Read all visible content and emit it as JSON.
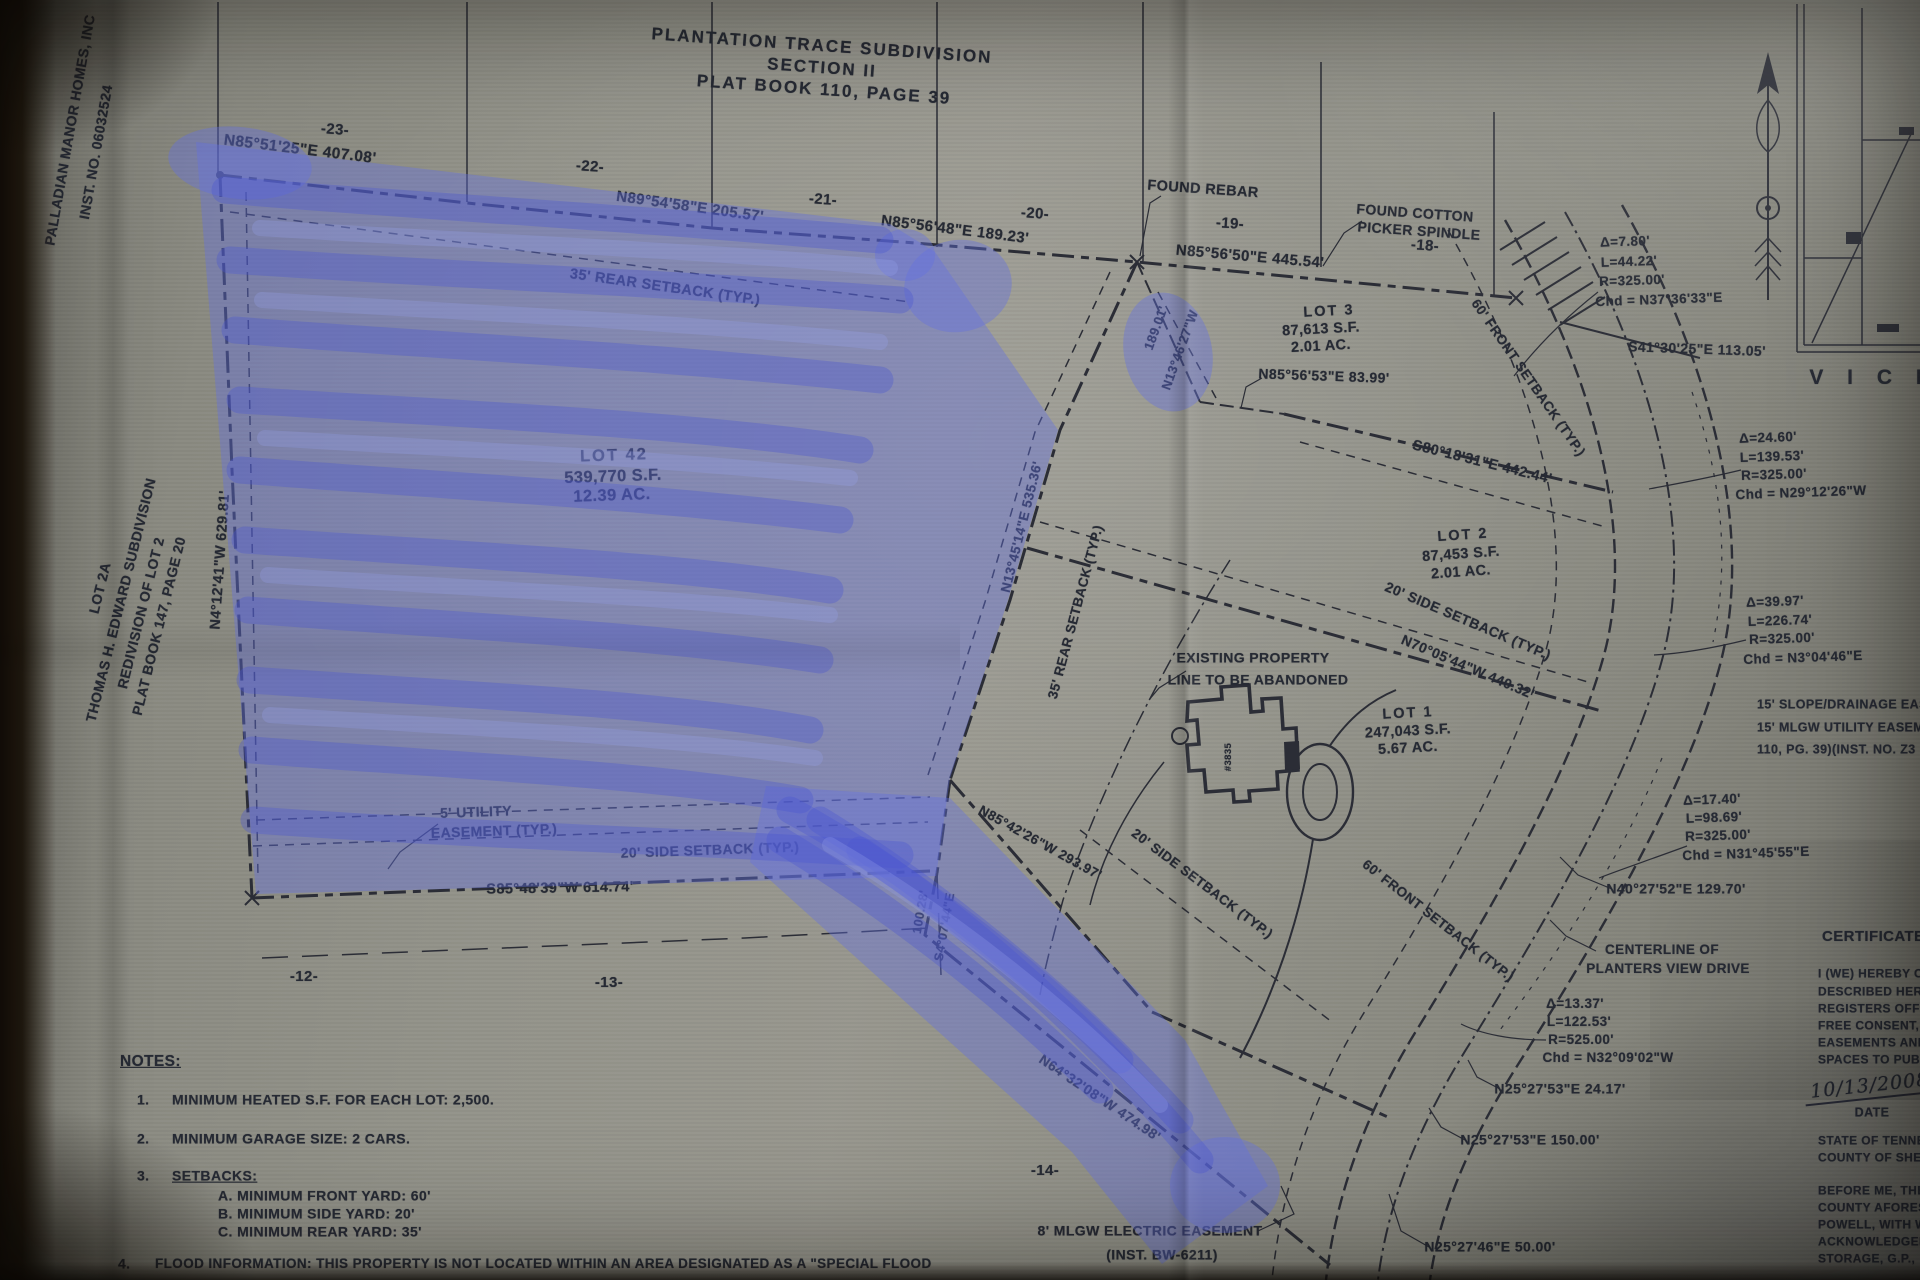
{
  "colors": {
    "ink": "#2b2d36",
    "ink2": "#262a34",
    "paper": "#93938a",
    "background": "#15100a",
    "highlighter_fill": "#6470e0",
    "highlighter_stroke": "#4a55d2",
    "highlighter_light": "#98a2ee"
  },
  "summary": {
    "title": {
      "line1": "PLANTATION TRACE SUBDIVISION",
      "line2": "SECTION II",
      "line3": "PLAT BOOK 110, PAGE 39"
    },
    "owner_note": [
      "PALLADIAN MANOR HOMES, INC",
      "INST. NO. 06032524"
    ],
    "adjacent_property": [
      "LOT 2A",
      "THOMAS H. EDWARD SUBDIVISION",
      "REDIVISION OF LOT 2",
      "PLAT BOOK 147, PAGE 20"
    ],
    "lots": [
      {
        "name": "LOT 42",
        "area_sf": "539,770 S.F.",
        "acres": "12.39 AC."
      },
      {
        "name": "LOT 3",
        "area_sf": "87,613 S.F.",
        "acres": "2.01 AC."
      },
      {
        "name": "LOT 2",
        "area_sf": "87,453 S.F.",
        "acres": "2.01 AC."
      },
      {
        "name": "LOT 1",
        "area_sf": "247,043 S.F.",
        "acres": "5.67 AC."
      }
    ],
    "curves": [
      {
        "delta": "Δ=7.80'",
        "length": "L=44.22'",
        "radius": "R=325.00'",
        "chord": "Chd = N37°36'33\"E"
      },
      {
        "delta": "Δ=24.60'",
        "length": "L=139.53'",
        "radius": "R=325.00'",
        "chord": "Chd = N29°12'26\"W"
      },
      {
        "delta": "Δ=39.97'",
        "length": "L=226.74'",
        "radius": "R=325.00'",
        "chord": "Chd = N3°04'46\"E"
      },
      {
        "delta": "Δ=17.40'",
        "length": "L=98.69'",
        "radius": "R=325.00'",
        "chord": "Chd = N31°45'55\"E"
      },
      {
        "delta": "Δ=13.37'",
        "length": "L=122.53'",
        "radius": "R=525.00'",
        "chord": "Chd = N32°09'02\"W"
      }
    ],
    "street": "PLANTERS VIEW DRIVE",
    "notes_heading": "NOTES:",
    "notes": [
      "MINIMUM HEATED S.F. FOR EACH LOT: 2,500.",
      "MINIMUM GARAGE SIZE: 2 CARS.",
      "SETBACKS:  A. MINIMUM FRONT YARD: 60'  B. MINIMUM SIDE YARD: 20'  C. MINIMUM REAR YARD: 35'",
      "FLOOD INFORMATION: THIS PROPERTY IS NOT LOCATED WITHIN AN AREA DESIGNATED AS A \"SPECIAL FLOOD"
    ],
    "certificate_partial": [
      "CERTIFICATE O",
      "I (WE) HEREBY C",
      "DESCRIBED HERE",
      "REGISTERS OFFIC",
      "FREE CONSENT, E",
      "EASEMENTS AND",
      "SPACES TO PUBL",
      "DATE",
      "STATE OF TENNE",
      "COUNTY OF SHEL",
      "BEFORE ME, THE",
      "COUNTY AFORESA",
      "POWELL, WITH W",
      "ACKNOWLEDGED",
      "STORAGE, G.P.,"
    ],
    "date_handwritten": "10/13/2008"
  },
  "labels": [
    {
      "n": "title-line-1",
      "t": "PLANTATION TRACE SUBDIVISION",
      "x": 822,
      "y": 46,
      "r": 4,
      "s": 17,
      "ls": 2
    },
    {
      "n": "title-line-2",
      "t": "SECTION II",
      "x": 822,
      "y": 68,
      "r": 4,
      "s": 17,
      "ls": 2
    },
    {
      "n": "title-line-3",
      "t": "PLAT BOOK 110, PAGE 39",
      "x": 824,
      "y": 90,
      "r": 4,
      "s": 17,
      "ls": 2
    },
    {
      "n": "owner-name",
      "t": "PALLADIAN MANOR HOMES, INC",
      "x": 70,
      "y": 130,
      "r": -80,
      "s": 14
    },
    {
      "n": "owner-inst-no",
      "t": "INST. NO. 06032524",
      "x": 96,
      "y": 152,
      "r": -80,
      "s": 14
    },
    {
      "n": "adjacent-lot2a",
      "t": "LOT 2A",
      "x": 100,
      "y": 588,
      "r": -76,
      "s": 14
    },
    {
      "n": "adjacent-subdivision",
      "t": "THOMAS H. EDWARD SUBDIVISION",
      "x": 121,
      "y": 600,
      "r": -76,
      "s": 14
    },
    {
      "n": "adjacent-redivision",
      "t": "REDIVISION OF LOT 2",
      "x": 141,
      "y": 613,
      "r": -76,
      "s": 14
    },
    {
      "n": "adjacent-platbook",
      "t": "PLAT BOOK 147, PAGE 20",
      "x": 159,
      "y": 626,
      "r": -76,
      "s": 14
    },
    {
      "n": "bearing-west",
      "t": "N4°12'41\"W 629.81'",
      "x": 221,
      "y": 560,
      "r": -86,
      "s": 14.5
    },
    {
      "n": "grid-23",
      "t": "-23-",
      "x": 335,
      "y": 130,
      "r": 4,
      "s": 15
    },
    {
      "n": "grid-22",
      "t": "-22-",
      "x": 590,
      "y": 167,
      "r": 4,
      "s": 15
    },
    {
      "n": "grid-21",
      "t": "-21-",
      "x": 823,
      "y": 200,
      "r": 4,
      "s": 15
    },
    {
      "n": "grid-20",
      "t": "-20-",
      "x": 1035,
      "y": 214,
      "r": 4,
      "s": 15
    },
    {
      "n": "grid-19",
      "t": "-19-",
      "x": 1230,
      "y": 224,
      "r": 4,
      "s": 15
    },
    {
      "n": "grid-18",
      "t": "-18-",
      "x": 1425,
      "y": 246,
      "r": 4,
      "s": 15
    },
    {
      "n": "grid-12",
      "t": "-12-",
      "x": 304,
      "y": 977,
      "r": 0,
      "s": 15
    },
    {
      "n": "grid-13",
      "t": "-13-",
      "x": 609,
      "y": 983,
      "r": 0,
      "s": 15
    },
    {
      "n": "grid-14",
      "t": "-14-",
      "x": 1045,
      "y": 1171,
      "r": 0,
      "s": 15
    },
    {
      "n": "bearing-north-1",
      "t": "N85°51'25\"E 407.08'",
      "x": 300,
      "y": 150,
      "r": 7,
      "s": 15.5
    },
    {
      "n": "bearing-north-2",
      "t": "N89°54'58\"E 205.57'",
      "x": 690,
      "y": 207,
      "r": 8,
      "s": 15
    },
    {
      "n": "bearing-north-3",
      "t": "N85°56'48\"E 189.23'",
      "x": 955,
      "y": 230,
      "r": 7,
      "s": 15
    },
    {
      "n": "bearing-north-4",
      "t": "N85°56'50\"E 445.54'",
      "x": 1250,
      "y": 257,
      "r": 5,
      "s": 15
    },
    {
      "n": "found-rebar-label",
      "t": "FOUND REBAR",
      "x": 1203,
      "y": 190,
      "r": 4,
      "s": 14.5
    },
    {
      "n": "found-cotton-label-1",
      "t": "FOUND COTTON",
      "x": 1415,
      "y": 213,
      "r": 4,
      "s": 14
    },
    {
      "n": "found-cotton-label-2",
      "t": "PICKER SPINDLE",
      "x": 1419,
      "y": 231,
      "r": 4,
      "s": 14
    },
    {
      "n": "rear-setback-top",
      "t": "35' REAR SETBACK (TYP.)",
      "x": 665,
      "y": 288,
      "r": 8,
      "s": 14.5
    },
    {
      "n": "lot42-name",
      "t": "LOT 42",
      "x": 614,
      "y": 456,
      "r": -2,
      "s": 16.5,
      "ls": 2
    },
    {
      "n": "lot42-area",
      "t": "539,770 S.F.",
      "x": 613,
      "y": 477,
      "r": -2,
      "s": 16.5
    },
    {
      "n": "lot42-acres",
      "t": "12.39 AC.",
      "x": 612,
      "y": 496,
      "r": -2,
      "s": 16.5
    },
    {
      "n": "dist-189",
      "t": "189.01'",
      "x": 1156,
      "y": 328,
      "r": -70,
      "s": 13
    },
    {
      "n": "bearing-n1346",
      "t": "N13°46'27\"W",
      "x": 1180,
      "y": 350,
      "r": -70,
      "s": 13
    },
    {
      "n": "lot3-name",
      "t": "LOT 3",
      "x": 1329,
      "y": 312,
      "r": -3,
      "s": 14.5,
      "ls": 2
    },
    {
      "n": "lot3-area",
      "t": "87,613 S.F.",
      "x": 1321,
      "y": 330,
      "r": -3,
      "s": 14.5
    },
    {
      "n": "lot3-acres",
      "t": "2.01 AC.",
      "x": 1321,
      "y": 347,
      "r": -3,
      "s": 14.5
    },
    {
      "n": "bearing-lot3-south",
      "t": "N85°56'53\"E 83.99'",
      "x": 1324,
      "y": 376,
      "r": 2,
      "s": 14
    },
    {
      "n": "front-setback-upper",
      "t": "60' FRONT SETBACK (TYP.)",
      "x": 1528,
      "y": 378,
      "r": 55,
      "s": 13.5
    },
    {
      "n": "bearing-s41",
      "t": "S41°30'25\"E 113.05'",
      "x": 1697,
      "y": 349,
      "r": 2,
      "s": 14
    },
    {
      "n": "curve1-delta",
      "t": "Δ=7.80'",
      "x": 1625,
      "y": 242,
      "r": -2,
      "s": 13.5
    },
    {
      "n": "curve1-length",
      "t": "L=44.22'",
      "x": 1629,
      "y": 262,
      "r": -2,
      "s": 13.5
    },
    {
      "n": "curve1-radius",
      "t": "R=325.00'",
      "x": 1632,
      "y": 281,
      "r": -2,
      "s": 13.5
    },
    {
      "n": "curve1-chord",
      "t": "Chd = N37°36'33\"E",
      "x": 1659,
      "y": 300,
      "r": -2,
      "s": 13.5
    },
    {
      "n": "curve2-delta",
      "t": "Δ=24.60'",
      "x": 1768,
      "y": 438,
      "r": -2,
      "s": 13.5
    },
    {
      "n": "curve2-length",
      "t": "L=139.53'",
      "x": 1772,
      "y": 457,
      "r": -2,
      "s": 13.5
    },
    {
      "n": "curve2-radius",
      "t": "R=325.00'",
      "x": 1774,
      "y": 475,
      "r": -2,
      "s": 13.5
    },
    {
      "n": "curve2-chord",
      "t": "Chd = N29°12'26\"W",
      "x": 1801,
      "y": 493,
      "r": -2,
      "s": 13.5
    },
    {
      "n": "vicinity-caption",
      "t": "V I C I",
      "x": 1870,
      "y": 378,
      "r": 0,
      "s": 21,
      "ls": 9
    },
    {
      "n": "bearing-s80",
      "t": "S80°18'31\"E 442.44'",
      "x": 1482,
      "y": 463,
      "r": 14,
      "s": 14.5
    },
    {
      "n": "lot2-name",
      "t": "LOT 2",
      "x": 1463,
      "y": 536,
      "r": -4,
      "s": 14.5,
      "ls": 2
    },
    {
      "n": "lot2-area",
      "t": "87,453 S.F.",
      "x": 1461,
      "y": 555,
      "r": -4,
      "s": 14.5
    },
    {
      "n": "lot2-acres",
      "t": "2.01 AC.",
      "x": 1461,
      "y": 573,
      "r": -4,
      "s": 14.5
    },
    {
      "n": "side-setback-lot2",
      "t": "20' SIDE SETBACK (TYP.)",
      "x": 1468,
      "y": 621,
      "r": 23,
      "s": 14
    },
    {
      "n": "bearing-n70",
      "t": "N70°05'44\"W 440.32'",
      "x": 1468,
      "y": 667,
      "r": 23,
      "s": 14
    },
    {
      "n": "curve3-delta",
      "t": "Δ=39.97'",
      "x": 1775,
      "y": 602,
      "r": -2,
      "s": 13.5
    },
    {
      "n": "curve3-length",
      "t": "L=226.74'",
      "x": 1780,
      "y": 621,
      "r": -2,
      "s": 13.5
    },
    {
      "n": "curve3-radius",
      "t": "R=325.00'",
      "x": 1782,
      "y": 639,
      "r": -2,
      "s": 13.5
    },
    {
      "n": "curve3-chord",
      "t": "Chd = N3°04'46\"E",
      "x": 1803,
      "y": 658,
      "r": -2,
      "s": 13.5
    },
    {
      "n": "slope-easement-1",
      "t": "15' SLOPE/DRAINAGE EASE",
      "x": 1757,
      "y": 705,
      "r": 0,
      "s": 12.5,
      "al": "l"
    },
    {
      "n": "slope-easement-2",
      "t": "15' MLGW UTILITY EASEMEN",
      "x": 1757,
      "y": 728,
      "r": 0,
      "s": 12.5,
      "al": "l"
    },
    {
      "n": "slope-easement-3",
      "t": "110, PG. 39)(INST. NO. Z3",
      "x": 1757,
      "y": 750,
      "r": 0,
      "s": 12.5,
      "al": "l"
    },
    {
      "n": "rear-setback-diagonal",
      "t": "35' REAR SETBACK (TYP.)",
      "x": 1076,
      "y": 612,
      "r": -75,
      "s": 13.5
    },
    {
      "n": "bearing-n1345",
      "t": "N13°45'14\"E 535.36'",
      "x": 1022,
      "y": 527,
      "r": -76,
      "s": 13.5
    },
    {
      "n": "existing-line-label-1",
      "t": "EXISTING PROPERTY",
      "x": 1253,
      "y": 658,
      "r": 0,
      "s": 14
    },
    {
      "n": "existing-line-label-2",
      "t": "LINE TO BE ABANDONED",
      "x": 1258,
      "y": 680,
      "r": 0,
      "s": 14
    },
    {
      "n": "lot1-name",
      "t": "LOT 1",
      "x": 1408,
      "y": 714,
      "r": -3,
      "s": 14.5,
      "ls": 2
    },
    {
      "n": "lot1-area",
      "t": "247,043 S.F.",
      "x": 1408,
      "y": 732,
      "r": -3,
      "s": 14.5
    },
    {
      "n": "lot1-acres",
      "t": "5.67 AC.",
      "x": 1408,
      "y": 749,
      "r": -3,
      "s": 14.5
    },
    {
      "n": "house-number",
      "t": "#3835",
      "x": 1229,
      "y": 757,
      "r": -90,
      "s": 9.5
    },
    {
      "n": "curve4-delta",
      "t": "Δ=17.40'",
      "x": 1712,
      "y": 800,
      "r": -2,
      "s": 13.5
    },
    {
      "n": "curve4-length",
      "t": "L=98.69'",
      "x": 1714,
      "y": 818,
      "r": -2,
      "s": 13.5
    },
    {
      "n": "curve4-radius",
      "t": "R=325.00'",
      "x": 1718,
      "y": 836,
      "r": -2,
      "s": 13.5
    },
    {
      "n": "curve4-chord",
      "t": "Chd = N31°45'55\"E",
      "x": 1746,
      "y": 854,
      "r": -2,
      "s": 13.5
    },
    {
      "n": "bearing-n40",
      "t": "N40°27'52\"E 129.70'",
      "x": 1676,
      "y": 889,
      "r": 0,
      "s": 14
    },
    {
      "n": "centerline-label-1",
      "t": "CENTERLINE OF",
      "x": 1662,
      "y": 950,
      "r": 0,
      "s": 13.5
    },
    {
      "n": "centerline-label-2",
      "t": "PLANTERS VIEW DRIVE",
      "x": 1668,
      "y": 969,
      "r": 0,
      "s": 13.5
    },
    {
      "n": "front-setback-lower",
      "t": "60' FRONT SETBACK (TYP.)",
      "x": 1438,
      "y": 921,
      "r": 38,
      "s": 13.5
    },
    {
      "n": "side-setback-lot1",
      "t": "20' SIDE SETBACK (TYP.)",
      "x": 1202,
      "y": 884,
      "r": 37,
      "s": 13.5
    },
    {
      "n": "bearing-n8542",
      "t": "N85°42'26\"W 293.97'",
      "x": 1040,
      "y": 843,
      "r": 29,
      "s": 13.5
    },
    {
      "n": "dist-10028",
      "t": "100.28'",
      "x": 921,
      "y": 912,
      "r": -80,
      "s": 12.5
    },
    {
      "n": "bearing-s407",
      "t": "S4°07'44\"E",
      "x": 945,
      "y": 927,
      "r": -80,
      "s": 12.5
    },
    {
      "n": "utility-easement-1",
      "t": "5' UTILITY",
      "x": 476,
      "y": 812,
      "r": -2,
      "s": 14
    },
    {
      "n": "utility-easement-2",
      "t": "EASEMENT (TYP.)",
      "x": 494,
      "y": 831,
      "r": -2,
      "s": 14
    },
    {
      "n": "side-setback-lot42",
      "t": "20' SIDE SETBACK (TYP.)",
      "x": 710,
      "y": 850,
      "r": -2,
      "s": 14
    },
    {
      "n": "bearing-s8548",
      "t": "S85°48'39\"W 614.74'",
      "x": 560,
      "y": 889,
      "r": -1,
      "s": 14.5
    },
    {
      "n": "curve5-delta",
      "t": "Δ=13.37'",
      "x": 1575,
      "y": 1004,
      "r": 0,
      "s": 13.5
    },
    {
      "n": "curve5-length",
      "t": "L=122.53'",
      "x": 1579,
      "y": 1022,
      "r": 0,
      "s": 13.5
    },
    {
      "n": "curve5-radius",
      "t": "R=525.00'",
      "x": 1581,
      "y": 1040,
      "r": 0,
      "s": 13.5
    },
    {
      "n": "curve5-chord",
      "t": "Chd = N32°09'02\"W",
      "x": 1608,
      "y": 1058,
      "r": 0,
      "s": 13.5
    },
    {
      "n": "bearing-n25-2417",
      "t": "N25°27'53\"E 24.17'",
      "x": 1560,
      "y": 1089,
      "r": 0,
      "s": 14
    },
    {
      "n": "bearing-n25-150",
      "t": "N25°27'53\"E 150.00'",
      "x": 1530,
      "y": 1140,
      "r": 0,
      "s": 14
    },
    {
      "n": "bearing-n25-50",
      "t": "N25°27'46\"E 50.00'",
      "x": 1490,
      "y": 1247,
      "r": 0,
      "s": 14
    },
    {
      "n": "bearing-n64",
      "t": "N64°32'08\"W 474.98'",
      "x": 1100,
      "y": 1098,
      "r": 34,
      "s": 14
    },
    {
      "n": "mlgw-easement-1",
      "t": "8' MLGW ELECTRIC EASEMENT",
      "x": 1150,
      "y": 1231,
      "r": 0,
      "s": 14
    },
    {
      "n": "mlgw-easement-2",
      "t": "(INST. BW-6211)",
      "x": 1162,
      "y": 1255,
      "r": 0,
      "s": 14
    },
    {
      "n": "notes-heading",
      "t": "NOTES:",
      "x": 120,
      "y": 1062,
      "r": 0,
      "s": 15.5,
      "al": "l",
      "u": true
    },
    {
      "n": "note-1-num",
      "t": "1.",
      "x": 137,
      "y": 1100,
      "r": 0,
      "s": 14,
      "al": "l"
    },
    {
      "n": "note-1-text",
      "t": "MINIMUM HEATED S.F. FOR EACH LOT: 2,500.",
      "x": 172,
      "y": 1100,
      "r": 0,
      "s": 14,
      "al": "l"
    },
    {
      "n": "note-2-num",
      "t": "2.",
      "x": 137,
      "y": 1139,
      "r": 0,
      "s": 14,
      "al": "l"
    },
    {
      "n": "note-2-text",
      "t": "MINIMUM GARAGE SIZE: 2 CARS.",
      "x": 172,
      "y": 1139,
      "r": 0,
      "s": 14,
      "al": "l"
    },
    {
      "n": "note-3-num",
      "t": "3.",
      "x": 137,
      "y": 1176,
      "r": 0,
      "s": 14,
      "al": "l"
    },
    {
      "n": "note-3-text",
      "t": "SETBACKS:",
      "x": 172,
      "y": 1176,
      "r": 0,
      "s": 14,
      "al": "l",
      "u": true
    },
    {
      "n": "note-3a-text",
      "t": "A. MINIMUM FRONT YARD: 60'",
      "x": 218,
      "y": 1196,
      "r": 0,
      "s": 14,
      "al": "l"
    },
    {
      "n": "note-3b-text",
      "t": "B. MINIMUM SIDE YARD: 20'",
      "x": 218,
      "y": 1214,
      "r": 0,
      "s": 14,
      "al": "l"
    },
    {
      "n": "note-3c-text",
      "t": "C. MINIMUM REAR YARD: 35'",
      "x": 218,
      "y": 1232,
      "r": 0,
      "s": 14,
      "al": "l"
    },
    {
      "n": "note-4-num",
      "t": "4.",
      "x": 118,
      "y": 1264,
      "r": 0,
      "s": 14,
      "al": "l"
    },
    {
      "n": "note-4-text",
      "t": "FLOOD INFORMATION: THIS PROPERTY IS NOT LOCATED WITHIN AN AREA DESIGNATED AS A \"SPECIAL FLOOD",
      "x": 155,
      "y": 1264,
      "r": 0,
      "s": 13.5,
      "al": "l"
    },
    {
      "n": "certificate-heading",
      "t": "CERTIFICATE O",
      "x": 1822,
      "y": 937,
      "r": 0,
      "s": 15,
      "al": "l"
    },
    {
      "n": "certificate-line-1",
      "t": "I (WE) HEREBY C",
      "x": 1818,
      "y": 974,
      "r": 0,
      "s": 12,
      "al": "l"
    },
    {
      "n": "certificate-line-2",
      "t": "DESCRIBED HERE",
      "x": 1818,
      "y": 992,
      "r": 0,
      "s": 12,
      "al": "l"
    },
    {
      "n": "certificate-line-3",
      "t": "REGISTERS OFFIC",
      "x": 1818,
      "y": 1009,
      "r": 0,
      "s": 12,
      "al": "l"
    },
    {
      "n": "certificate-line-4",
      "t": "FREE CONSENT, E",
      "x": 1818,
      "y": 1026,
      "r": 0,
      "s": 12,
      "al": "l"
    },
    {
      "n": "certificate-line-5",
      "t": "EASEMENTS AND",
      "x": 1818,
      "y": 1043,
      "r": 0,
      "s": 12,
      "al": "l"
    },
    {
      "n": "certificate-line-6",
      "t": "SPACES TO PUBL",
      "x": 1818,
      "y": 1060,
      "r": 0,
      "s": 12,
      "al": "l"
    },
    {
      "n": "signature-date",
      "t": "10/13/2008",
      "x": 1870,
      "y": 1088,
      "r": -6,
      "s": 19,
      "cls": "hand"
    },
    {
      "n": "date-label",
      "t": "DATE",
      "x": 1872,
      "y": 1113,
      "r": 0,
      "s": 12.5
    },
    {
      "n": "state-line-1",
      "t": "STATE OF TENNE",
      "x": 1818,
      "y": 1141,
      "r": 0,
      "s": 12,
      "al": "l"
    },
    {
      "n": "state-line-2",
      "t": "COUNTY OF SHEL",
      "x": 1818,
      "y": 1158,
      "r": 0,
      "s": 12,
      "al": "l"
    },
    {
      "n": "notary-line-1",
      "t": "BEFORE ME, THE",
      "x": 1818,
      "y": 1191,
      "r": 0,
      "s": 12,
      "al": "l"
    },
    {
      "n": "notary-line-2",
      "t": "COUNTY AFORESA",
      "x": 1818,
      "y": 1208,
      "r": 0,
      "s": 12,
      "al": "l"
    },
    {
      "n": "notary-line-3",
      "t": "POWELL, WITH W",
      "x": 1818,
      "y": 1225,
      "r": 0,
      "s": 12,
      "al": "l"
    },
    {
      "n": "notary-line-4",
      "t": "ACKNOWLEDGED",
      "x": 1818,
      "y": 1242,
      "r": 0,
      "s": 12,
      "al": "l"
    },
    {
      "n": "notary-line-5",
      "t": "STORAGE, G.P.,",
      "x": 1818,
      "y": 1259,
      "r": 0,
      "s": 12,
      "al": "l"
    }
  ]
}
